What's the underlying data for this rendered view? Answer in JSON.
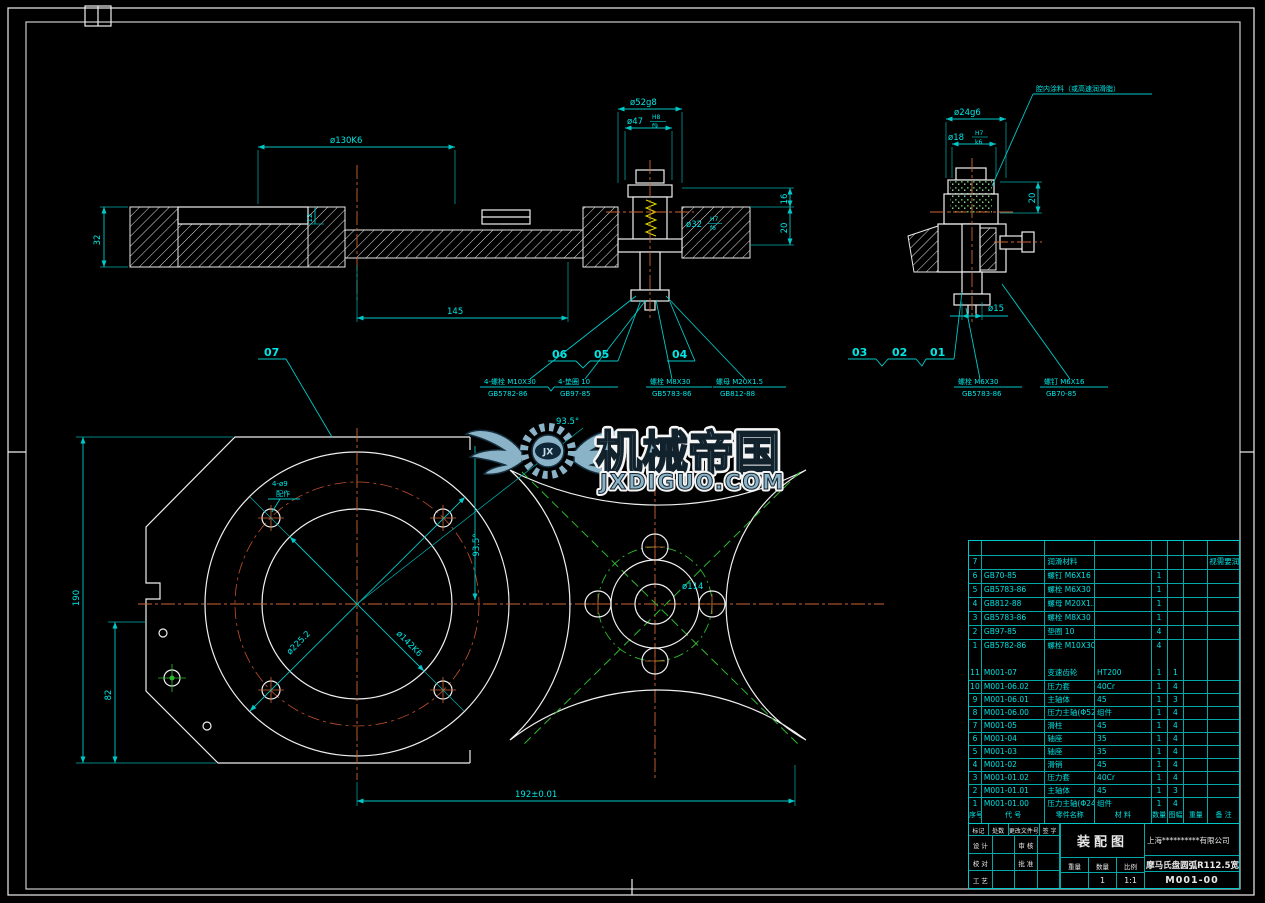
{
  "colors": {
    "background": "#000000",
    "geometry": "#f0f0f0",
    "dimension": "#00e0e0",
    "centerline": "#cc6633",
    "phantom_green": "#2db82d",
    "spring_yellow": "#e0e000",
    "logo_blue": "#8fb9ce"
  },
  "labels": {
    "b07": "07",
    "b06": "06",
    "b05": "05",
    "b04": "04",
    "b03": "03",
    "b02": "02",
    "b01": "01"
  },
  "dims": {
    "d130": "ø130K6",
    "d145": "145",
    "d32": "32",
    "d12": "12",
    "d52": "ø52g8",
    "d47": "ø47",
    "d47f_n": "H8",
    "d47f_d": "f9",
    "d16": "16",
    "d20": "20",
    "d32b": "ø32",
    "d32bf_n": "H7",
    "d32bf_d": "f6",
    "d24": "ø24g6",
    "d18": "ø18",
    "d18f_n": "H7",
    "d18f_d": "k6",
    "d20r": "20",
    "d15": "ø15",
    "d190": "190",
    "d82": "82",
    "d192": "192±0.01",
    "d225": "ø225.2",
    "d142": "ø142K6",
    "d935a": "93.5°",
    "d935b": "93.5°",
    "d114": "ø114",
    "d4x9a": "4-ø9",
    "d4x9b": "配作"
  },
  "callouts": {
    "c1a": "4-螺栓 M10X30",
    "c1b": "GB5782-86",
    "c2a": "4-垫圈 10",
    "c2b": "GB97-85",
    "c3a": "螺栓 M8X30",
    "c3b": "GB5783-86",
    "c4a": "螺母 M20X1.5",
    "c4b": "GB812-88",
    "c5a": "螺栓 M6X30",
    "c5b": "GB5783-86",
    "c6a": "螺钉 M6X16",
    "c6b": "GB70-85",
    "note": "腔内涂料（或高速润滑脂）"
  },
  "logo": {
    "cn": "机械帝国",
    "site": "JXDIGUO.COM",
    "monogram": "JX"
  },
  "bom": {
    "headers": [
      "序号",
      "代 号",
      "零件名称",
      "材 料",
      "数量",
      "图幅",
      "重量",
      "备 注"
    ],
    "std_rows": [
      {
        "no": "",
        "code": "",
        "name": "",
        "mat": "",
        "qty": "",
        "fmt": "",
        "wt": "",
        "rem": ""
      },
      {
        "no": "7",
        "code": "",
        "name": "润滑材料",
        "mat": "",
        "qty": "",
        "fmt": "",
        "wt": "",
        "rem": "视需要润滑"
      },
      {
        "no": "6",
        "code": "GB70-85",
        "name": "螺钉 M6X16",
        "mat": "",
        "qty": "1",
        "fmt": "",
        "wt": "",
        "rem": ""
      },
      {
        "no": "5",
        "code": "GB5783-86",
        "name": "螺栓 M6X30",
        "mat": "",
        "qty": "1",
        "fmt": "",
        "wt": "",
        "rem": ""
      },
      {
        "no": "4",
        "code": "GB812-88",
        "name": "螺母 M20X1.5",
        "mat": "",
        "qty": "1",
        "fmt": "",
        "wt": "",
        "rem": ""
      },
      {
        "no": "3",
        "code": "GB5783-86",
        "name": "螺栓 M8X30",
        "mat": "",
        "qty": "1",
        "fmt": "",
        "wt": "",
        "rem": ""
      },
      {
        "no": "2",
        "code": "GB97-85",
        "name": "垫圈 10",
        "mat": "",
        "qty": "4",
        "fmt": "",
        "wt": "",
        "rem": ""
      },
      {
        "no": "1",
        "code": "GB5782-86",
        "name": "螺栓 M10X30",
        "mat": "",
        "qty": "4",
        "fmt": "",
        "wt": "",
        "rem": ""
      }
    ],
    "part_rows": [
      {
        "no": "11",
        "code": "M001-07",
        "name": "变速齿轮",
        "mat": "HT200",
        "qty": "1",
        "fmt": "1",
        "wt": "",
        "rem": ""
      },
      {
        "no": "10",
        "code": "M001-06.02",
        "name": "压力套",
        "mat": "40Cr",
        "qty": "1",
        "fmt": "4",
        "wt": "",
        "rem": ""
      },
      {
        "no": "9",
        "code": "M001-06.01",
        "name": "主轴体",
        "mat": "45",
        "qty": "1",
        "fmt": "3",
        "wt": "",
        "rem": ""
      },
      {
        "no": "8",
        "code": "M001-06.00",
        "name": "压力主轴(Φ52)",
        "mat": "组件",
        "qty": "1",
        "fmt": "4",
        "wt": "",
        "rem": ""
      },
      {
        "no": "7",
        "code": "M001-05",
        "name": "滑柱",
        "mat": "45",
        "qty": "1",
        "fmt": "4",
        "wt": "",
        "rem": ""
      },
      {
        "no": "6",
        "code": "M001-04",
        "name": "轴座",
        "mat": "35",
        "qty": "1",
        "fmt": "4",
        "wt": "",
        "rem": ""
      },
      {
        "no": "5",
        "code": "M001-03",
        "name": "轴座",
        "mat": "35",
        "qty": "1",
        "fmt": "4",
        "wt": "",
        "rem": ""
      },
      {
        "no": "4",
        "code": "M001-02",
        "name": "滑销",
        "mat": "45",
        "qty": "1",
        "fmt": "4",
        "wt": "",
        "rem": ""
      },
      {
        "no": "3",
        "code": "M001-01.02",
        "name": "压力套",
        "mat": "40Cr",
        "qty": "1",
        "fmt": "4",
        "wt": "",
        "rem": ""
      },
      {
        "no": "2",
        "code": "M001-01.01",
        "name": "主轴体",
        "mat": "45",
        "qty": "1",
        "fmt": "3",
        "wt": "",
        "rem": ""
      },
      {
        "no": "1",
        "code": "M001-01.00",
        "name": "压力主轴(Φ24)",
        "mat": "组件",
        "qty": "1",
        "fmt": "4",
        "wt": "",
        "rem": ""
      }
    ]
  },
  "titleblock": {
    "company": "上海**********有限公司",
    "doc_type": "装配图",
    "product": "摩马氏盘圆弧R112.5宽",
    "drawing_no": "M001-00",
    "weight_value": "",
    "qty_value": "1",
    "scale_value": "1:1",
    "labels": {
      "mark": "标记",
      "count": "处数",
      "change_doc": "更改文件号",
      "sign": "签 字",
      "design": "设 计",
      "proof": "校 对",
      "process": "工 艺",
      "audit": "审 核",
      "approve": "批 准",
      "weight": "重量",
      "qty": "数量",
      "scale": "比例"
    }
  }
}
